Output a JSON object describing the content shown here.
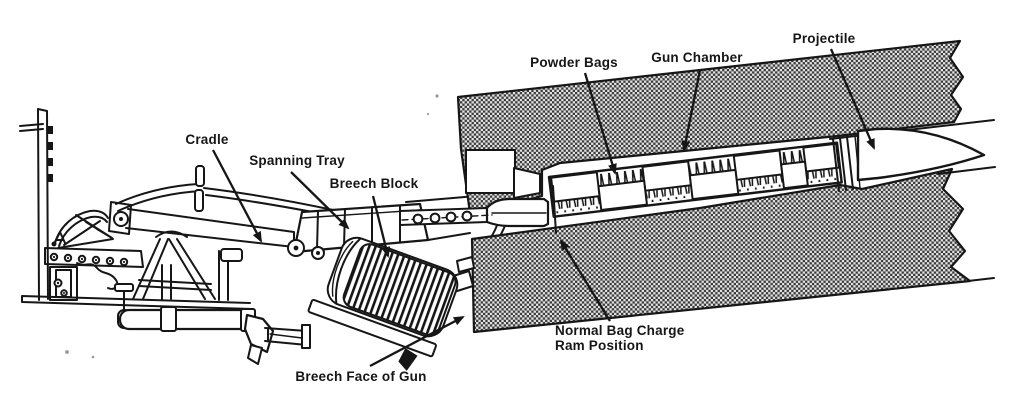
{
  "diagram": {
    "kind": "bag-charge-ramming-illustration",
    "colors": {
      "ink": "#161616",
      "paper": "#ffffff",
      "stipple_dark": "#3b3b3b",
      "stipple_light": "#e3e3e3"
    },
    "labels": {
      "cradle": "Cradle",
      "spanning_tray": "Spanning Tray",
      "breech_block": "Breech Block",
      "powder_bags": "Powder Bags",
      "gun_chamber": "Gun Chamber",
      "projectile": "Projectile",
      "ram_position_line1": "Normal Bag Charge",
      "ram_position_line2": "Ram Position",
      "breech_face": "Breech Face of Gun"
    }
  }
}
